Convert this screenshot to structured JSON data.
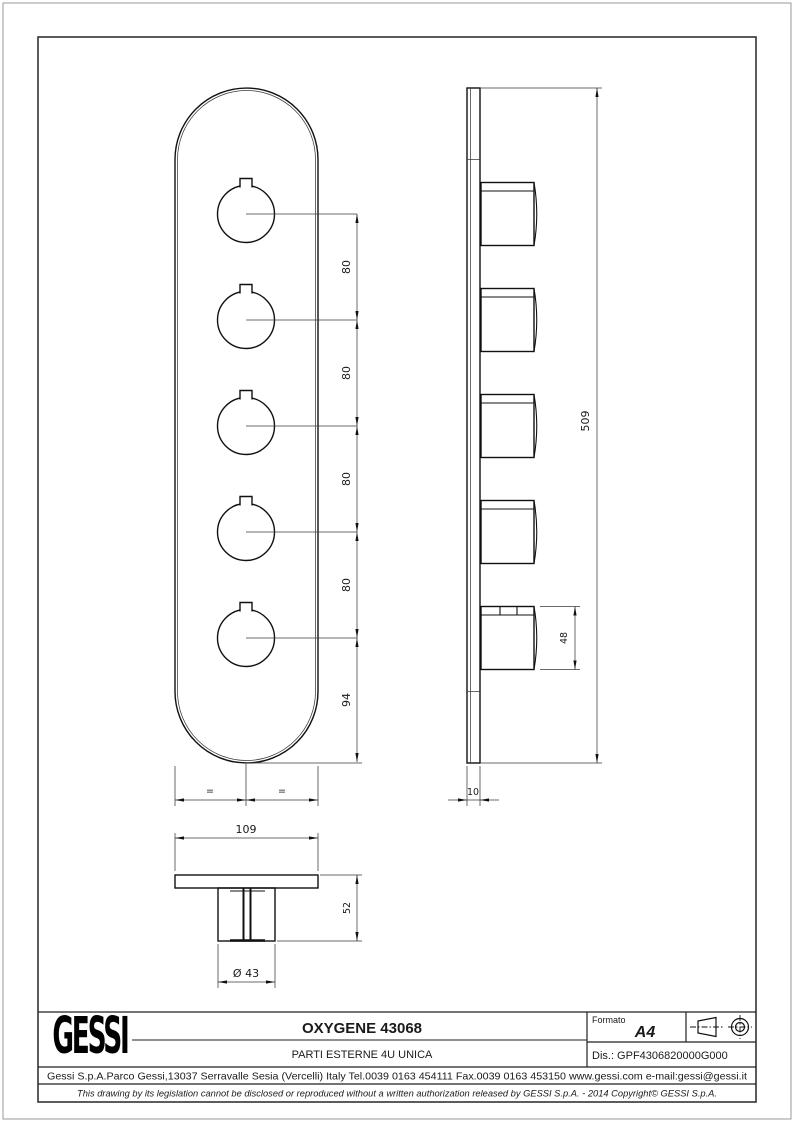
{
  "title_block": {
    "logo_text": "GESSI",
    "title": "OXYGENE 43068",
    "subtitle": "PARTI ESTERNE 4U UNICA",
    "formato_label": "Formato",
    "formato_value": "A4",
    "drawing_number": "Dis.: GPF4306820000G000",
    "address": "Gessi S.p.A.Parco Gessi,13037 Serravalle Sesia (Vercelli) Italy Tel.0039 0163 454111 Fax.0039 0163 453150 www.gessi.com e-mail:gessi@gessi.it",
    "legal": "This drawing by its legislation cannot be disclosed or reproduced without a written authorization released by GESSI S.p.A. - 2014 Copyright© GESSI S.p.A."
  },
  "dimensions": {
    "knob_pitch": "80",
    "bottom_offset": "94",
    "overall_height": "509",
    "knob_side_height": "48",
    "plate_thickness": "10",
    "plate_width": "109",
    "overall_depth": "52",
    "knob_diameter": "Ø 43",
    "equal_symbol": "="
  }
}
